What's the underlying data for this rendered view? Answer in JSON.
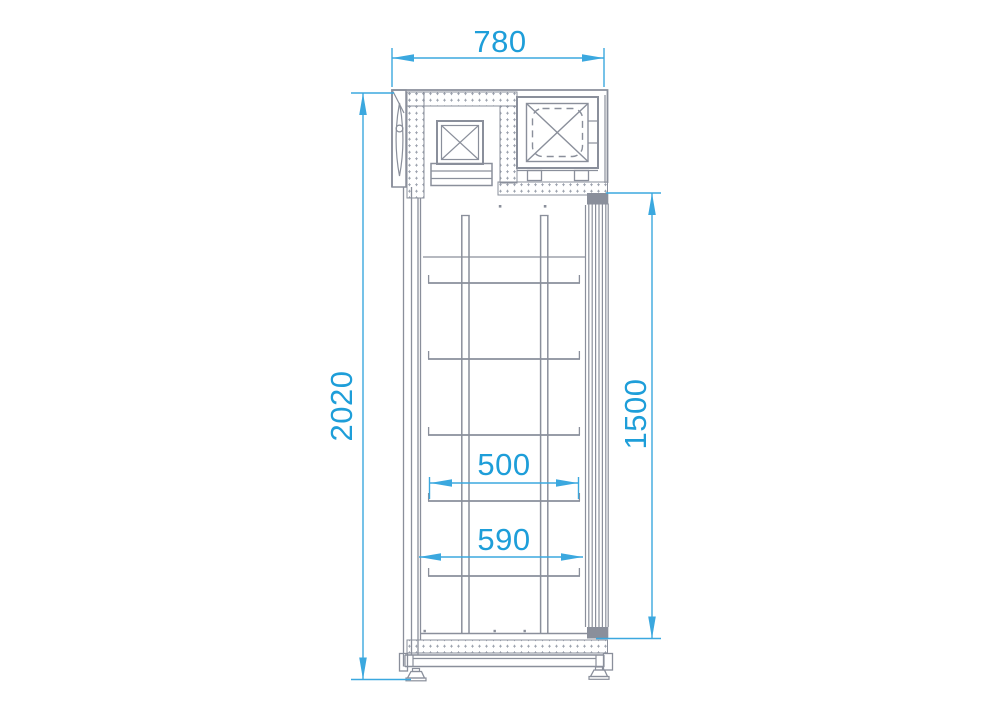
{
  "drawing": {
    "title": "cabinet-side-elevation",
    "colors": {
      "dimension_line": "#3BA8DF",
      "dimension_text": "#1E9ED9",
      "drawing_line": "#8A8F9B",
      "drawing_fill": "#8A8F9B",
      "background": "#FFFFFF"
    },
    "dimensions": {
      "overall_depth": {
        "value": "780"
      },
      "overall_height": {
        "value": "2020"
      },
      "door_height": {
        "value": "1500"
      },
      "shelf_depth": {
        "value": "500"
      },
      "interior_depth": {
        "value": "590"
      }
    }
  }
}
